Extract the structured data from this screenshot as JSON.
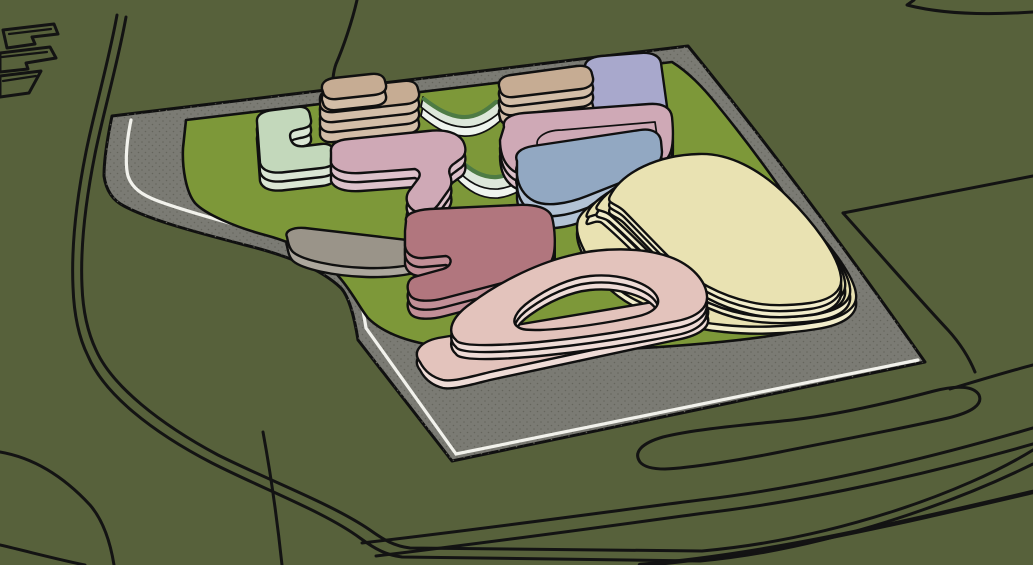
{
  "scene": {
    "type": "3d-massing-model-viewport",
    "view": "aerial-oblique",
    "description": "Architectural site massing model: organic rounded building volumes on a central lawn, surrounded by a gray paved apron with a white edge stripe, set in an olive-green context with black line-work of roads and neighboring parcels"
  },
  "colors": {
    "background": "#57613B",
    "outline": "#131313",
    "pavement": "#7B7B74",
    "pavement_dots": "#65655D",
    "curb_stripe": "#F2F2EC",
    "grass": "#7D9839",
    "bridge_roof": "#DDE7DA",
    "bridge_side": "#EFF4EE",
    "bridge_accent": "#4E7B44",
    "sage_roof": "#C3D8BB",
    "sage_side": "#DAE6D4",
    "tan_roof": "#C6AC93",
    "tan_side": "#D3BEA8",
    "lavender_roof": "#A8A8CC",
    "lavender_side": "#C0C0DC",
    "pink_roof": "#CFA9B6",
    "pink_side": "#DDC2CB",
    "blue_roof": "#92A8C2",
    "blue_side": "#B2C2D5",
    "maroon_roof": "#B1767E",
    "maroon_side": "#C28F97",
    "graypad_roof": "#9A9489",
    "graypad_side": "#ACA79D",
    "cream_roof": "#E9E2B2",
    "cream_side": "#F2EDCB",
    "blush_roof": "#E3C3BC",
    "blush_side": "#EFDCD7"
  },
  "site": {
    "lawn": "central lawn",
    "apron": "paved apron with dotted asphalt texture",
    "edge_marking": "white perimeter stripe"
  },
  "buildings": [
    {
      "id": "sage-court",
      "color": "sage",
      "levels": 2
    },
    {
      "id": "north-bar",
      "color": "tan",
      "levels": 3,
      "note": "rooftop penthouse volume"
    },
    {
      "id": "north-block",
      "color": "tan",
      "levels": 3
    },
    {
      "id": "lavender-u-block",
      "color": "lavender",
      "levels": 3
    },
    {
      "id": "rose-link-west",
      "color": "pink",
      "levels": 2
    },
    {
      "id": "rose-east",
      "color": "pink",
      "levels": 2,
      "note": "low rounded parapet wing"
    },
    {
      "id": "blue-wing",
      "color": "blue",
      "levels": 2
    },
    {
      "id": "maroon-studio",
      "color": "maroon",
      "levels": 2
    },
    {
      "id": "service-pad",
      "color": "graypad",
      "levels": 1
    },
    {
      "id": "terrace-hall",
      "color": "cream",
      "levels": 4,
      "note": "stepped terraces"
    },
    {
      "id": "blush-loop",
      "color": "blush",
      "levels": 2,
      "note": "ring volume with courtyard void on plinth"
    }
  ],
  "links": [
    {
      "id": "link-bridge-north",
      "color": "bridge"
    },
    {
      "id": "link-bridge-center",
      "color": "bridge"
    }
  ]
}
